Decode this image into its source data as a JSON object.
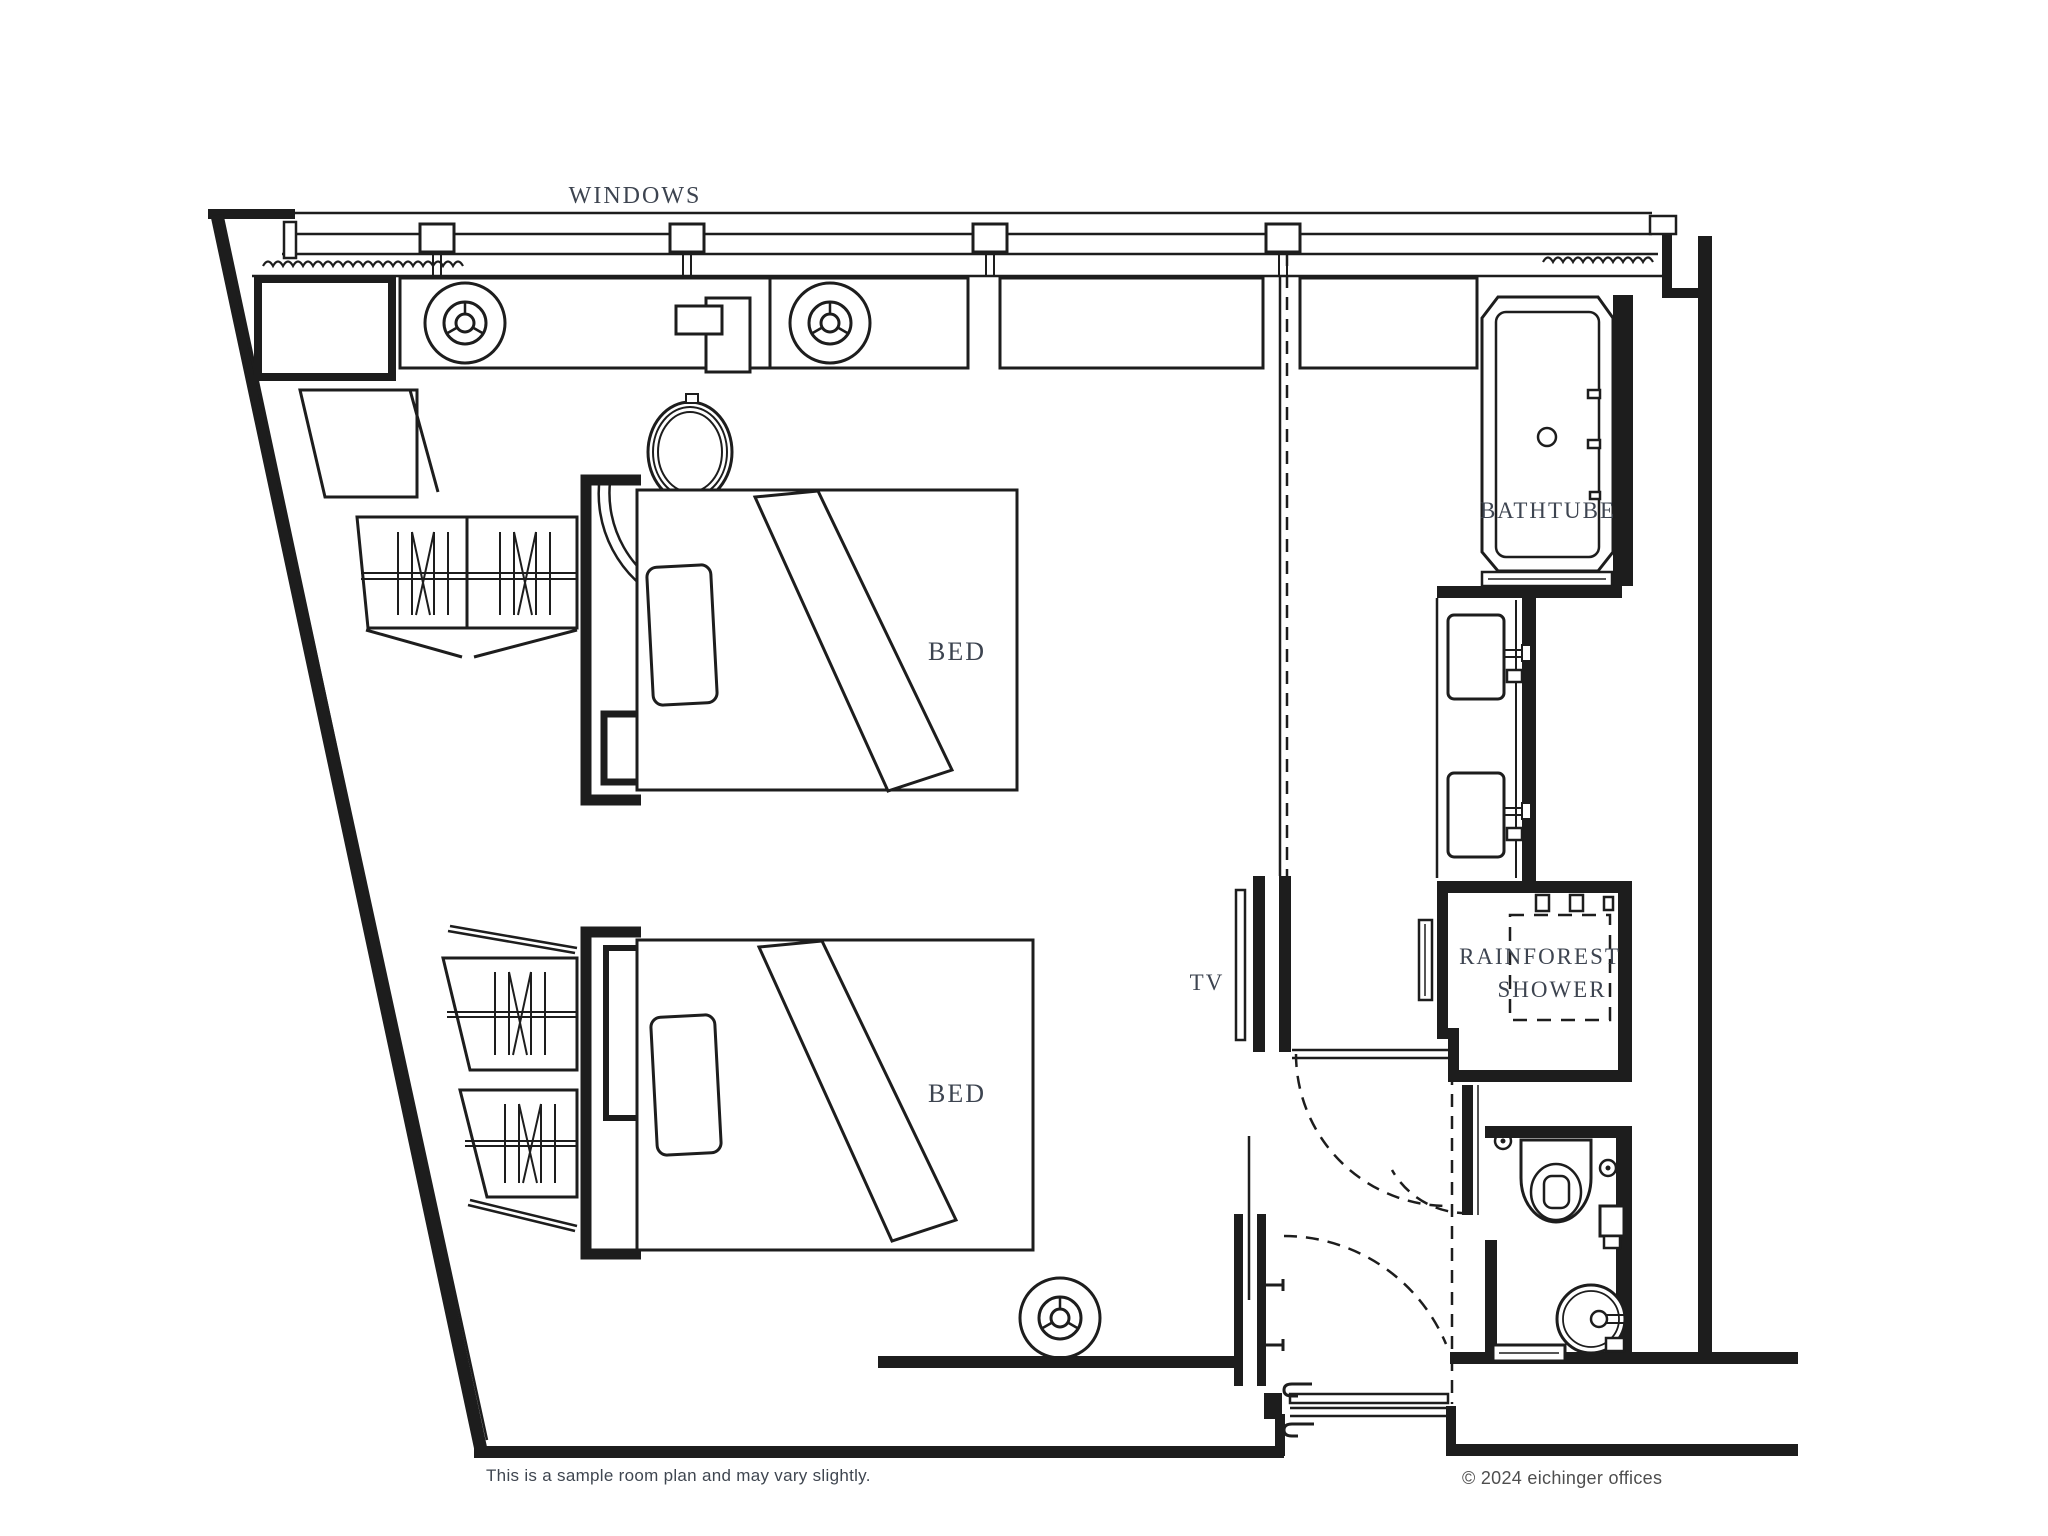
{
  "labels": {
    "windows": "WINDOWS",
    "bed": "BED",
    "bathtub": "BATHTUBE",
    "shower_line1": "RAINFOREST",
    "shower_line2": "SHOWER",
    "tv": "TV"
  },
  "footer": {
    "disclaimer": "This is a sample room plan and may vary slightly.",
    "copyright": "© 2024 eichinger offices"
  },
  "colors": {
    "wall": "#1d1d1d",
    "label": "#3d4450",
    "footnote_left": "#3f4650",
    "footnote_right": "#4e4e4e",
    "background": "#ffffff"
  }
}
